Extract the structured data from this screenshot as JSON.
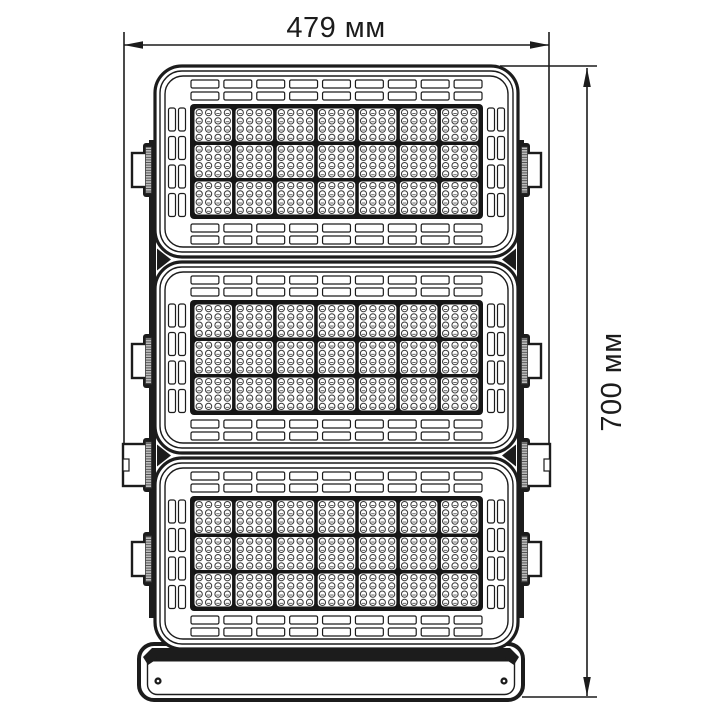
{
  "figure": {
    "type": "technical-dimension-drawing",
    "subject": "LED floodlight front view with three stacked LED modules and mounting yoke",
    "width_dimension": {
      "label": "479 мм"
    },
    "height_dimension": {
      "label": "700 мм"
    }
  },
  "drawing_spec": {
    "ink_color": "#1c1c1c",
    "background_color": "#ffffff",
    "knurl_fill": "#bdbdbd",
    "led_stroke_color": "#3c3c3c",
    "module_count": 3,
    "led_cell_grid": {
      "cols": 7,
      "rows": 3
    },
    "leds_per_cell": {
      "cols": 4,
      "rows": 4
    },
    "vent_slats": {
      "top_rows": 2,
      "bottom_rows": 2,
      "side_cols": 2,
      "dashes_per_row": 9,
      "dashes_per_col": 4
    },
    "side_brackets_per_side": 4,
    "junction_marks": 2,
    "yoke_holes": 2
  }
}
